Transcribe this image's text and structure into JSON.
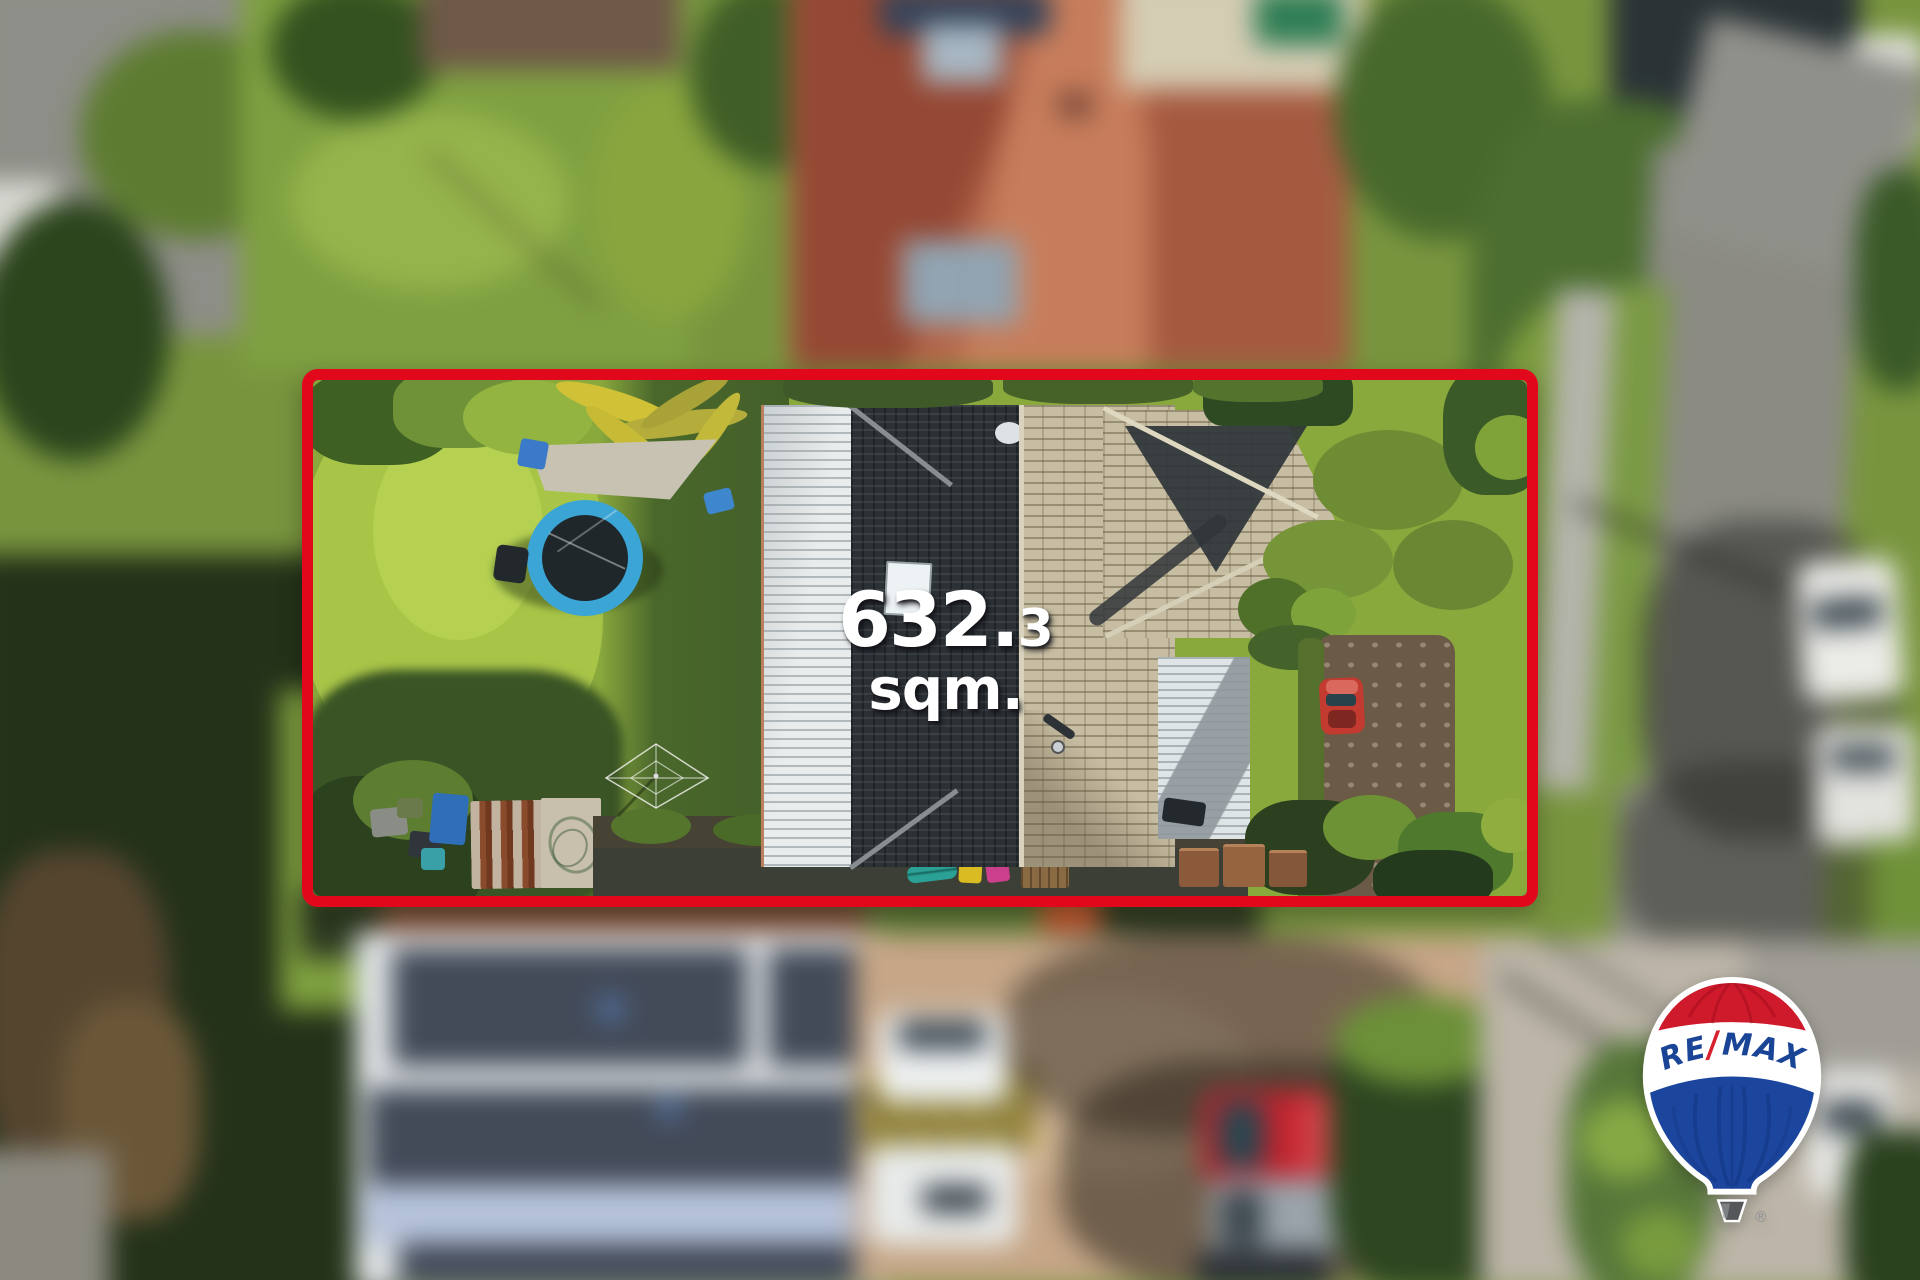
{
  "photo": {
    "kind": "aerial-drone-photograph-of-residential-property",
    "area_label": {
      "main": "632.",
      "small_digit": "3",
      "unit": "sqm."
    },
    "boundary": {
      "color": "#e2081c",
      "style": "rounded-rectangle-outline"
    }
  },
  "remax_logo": {
    "re": "RE",
    "slash": "/",
    "max": "MAX",
    "registered_symbol": "®",
    "colors": {
      "balloon_red": "#ce1a2b",
      "balloon_blue": "#1c469e",
      "wordmark_blue": "#1a4496",
      "slash_red": "#d7212e",
      "outline": "#ffffff",
      "basket": "#55575a"
    }
  }
}
